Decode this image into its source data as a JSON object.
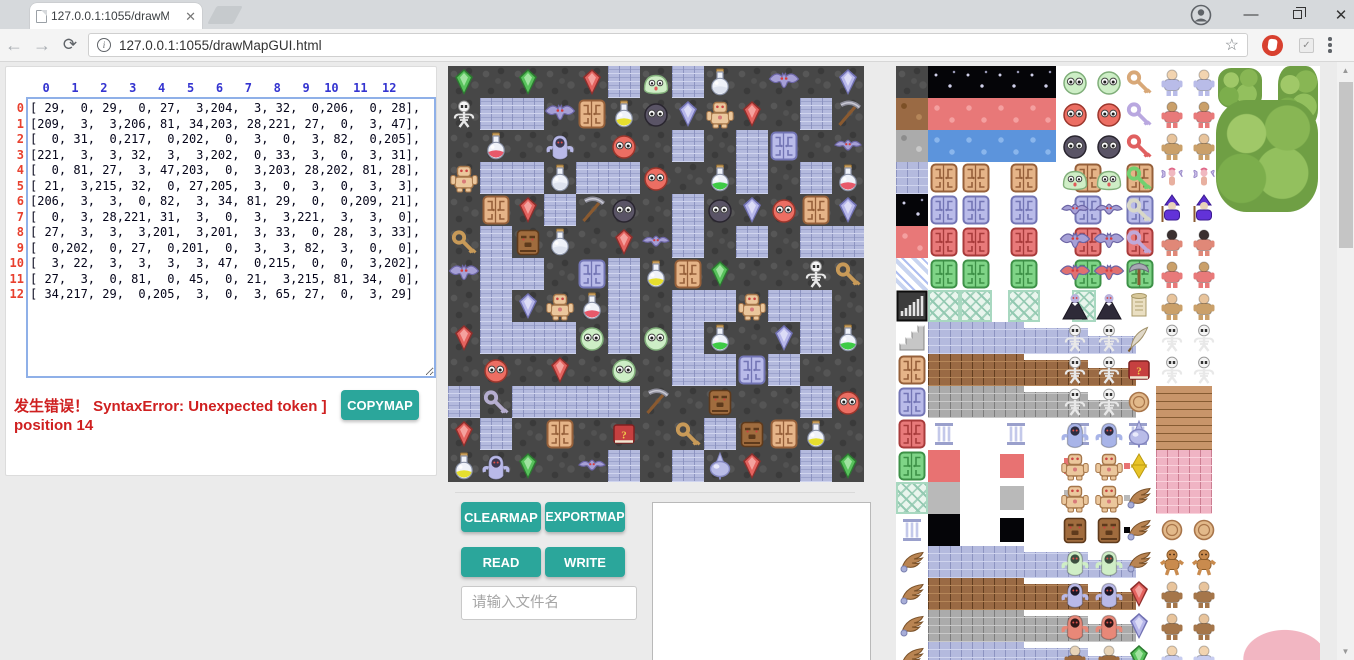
{
  "browser": {
    "tab_title": "127.0.0.1:1055/drawMa",
    "url": "127.0.0.1:1055/drawMapGUI.html"
  },
  "editor": {
    "col_headers": [
      "0",
      "1",
      "2",
      "3",
      "4",
      "5",
      "6",
      "7",
      "8",
      "9",
      "10",
      "11",
      "12"
    ],
    "row_headers": [
      "0",
      "1",
      "2",
      "3",
      "4",
      "5",
      "6",
      "7",
      "8",
      "9",
      "10",
      "11",
      "12"
    ],
    "error_line1": "发生错误！ SyntaxError: Unexpected token ]",
    "error_line2": "position 14",
    "copymap_label": "COPYMAP"
  },
  "map_matrix": [
    [
      29,
      0,
      29,
      0,
      27,
      3,
      204,
      3,
      32,
      0,
      206,
      0,
      28
    ],
    [
      209,
      3,
      3,
      206,
      81,
      34,
      203,
      28,
      221,
      27,
      0,
      3,
      47
    ],
    [
      0,
      31,
      0,
      217,
      0,
      202,
      0,
      3,
      0,
      3,
      82,
      0,
      205
    ],
    [
      221,
      3,
      3,
      32,
      3,
      3,
      202,
      0,
      33,
      3,
      0,
      3,
      31
    ],
    [
      0,
      81,
      27,
      3,
      47,
      203,
      0,
      3,
      203,
      28,
      202,
      81,
      28
    ],
    [
      21,
      3,
      215,
      32,
      0,
      27,
      205,
      3,
      0,
      3,
      0,
      3,
      3
    ],
    [
      206,
      3,
      3,
      0,
      82,
      3,
      34,
      81,
      29,
      0,
      0,
      209,
      21
    ],
    [
      0,
      3,
      28,
      221,
      31,
      3,
      0,
      3,
      3,
      221,
      3,
      3,
      0
    ],
    [
      27,
      3,
      3,
      3,
      201,
      3,
      201,
      3,
      33,
      0,
      28,
      3,
      33
    ],
    [
      0,
      202,
      0,
      27,
      0,
      201,
      0,
      3,
      3,
      82,
      3,
      0,
      0
    ],
    [
      3,
      22,
      3,
      3,
      3,
      3,
      47,
      0,
      215,
      0,
      0,
      3,
      202
    ],
    [
      27,
      3,
      0,
      81,
      0,
      45,
      0,
      21,
      3,
      215,
      81,
      34,
      0
    ],
    [
      34,
      217,
      29,
      0,
      205,
      3,
      0,
      3,
      65,
      27,
      0,
      3,
      29
    ]
  ],
  "controls": {
    "clearmap": "CLEARMAP",
    "exportmap": "EXPORTMAP",
    "read": "READ",
    "write": "WRITE",
    "filename_placeholder": "请输入文件名"
  },
  "colors": {
    "accent_teal": "#2ba69b",
    "col_header_blue": "#3434d0",
    "row_header_red": "#e8402e",
    "error_red": "#cf2020"
  },
  "tile_legend": {
    "0": "dark-stone-floor",
    "3": "brick-path",
    "21": "gold-key",
    "22": "silver-key",
    "27": "red-gem",
    "28": "violet-gem",
    "29": "green-gem",
    "31": "red-potion",
    "32": "silver-potion",
    "33": "green-potion",
    "34": "yellow-potion",
    "45": "red-book",
    "47": "pickaxe",
    "65": "spinning-top",
    "81": "tan-door",
    "82": "lavender-door",
    "201": "green-ball-monster",
    "202": "red-ball-monster",
    "203": "dark-ball-monster",
    "204": "green-slime",
    "205": "small-bat",
    "206": "big-bat",
    "209": "skeleton",
    "215": "tiki-statue",
    "217": "hooded-ghost",
    "221": "flesh-golem"
  },
  "tileset_sprites": [
    "dark-stone",
    "dirt",
    "gray-stone",
    "brick",
    "night-sky",
    "red-terrain",
    "water",
    "stripes",
    "bar-chart-tile",
    "stairs",
    "tan-door",
    "lavender-door",
    "red-door",
    "green-door",
    "lattice",
    "pillar",
    "wing-statue",
    "green-ball",
    "red-ball",
    "dark-ball",
    "slime",
    "small-bat",
    "big-bat",
    "red-bat",
    "vampire",
    "skeleton",
    "skeleton-shield",
    "skeleton-sword",
    "blue-skeleton",
    "golem",
    "tiki",
    "green-ghost",
    "blue-ghost",
    "red-ghost",
    "keys",
    "axe",
    "scroll",
    "quill",
    "red-book",
    "star-of-david",
    "wings",
    "red-gem",
    "violet-gem",
    "green-gem",
    "old-man",
    "monk",
    "barbarian",
    "fairy",
    "wizard",
    "reaper",
    "gingerbread",
    "angel",
    "trees"
  ]
}
